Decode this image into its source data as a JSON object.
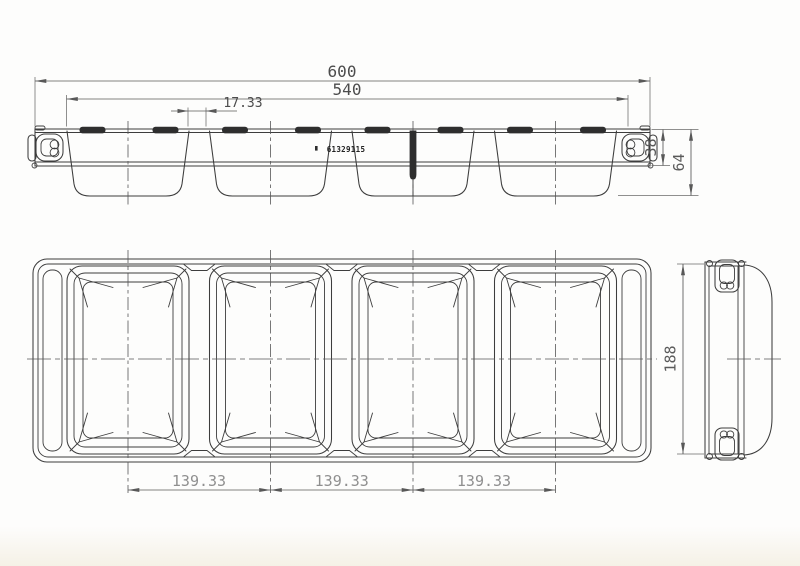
{
  "drawing": {
    "part_number": "61329115",
    "dimensions": {
      "overall_length": "600",
      "inner_length": "540",
      "divider_gap": "17.33",
      "rim_height": "38",
      "overall_height": "64",
      "overall_depth": "188",
      "compartment_pitch_1": "139.33",
      "compartment_pitch_2": "139.33",
      "compartment_pitch_3": "139.33"
    },
    "colors": {
      "line": "#3d3d3d",
      "dimension_line": "#585858",
      "dimension_text": "#4c4c4c",
      "dimension_text_light": "#8f8f8f",
      "dark_fill": "#2e2e2e",
      "background": "#fdfdfc"
    }
  }
}
